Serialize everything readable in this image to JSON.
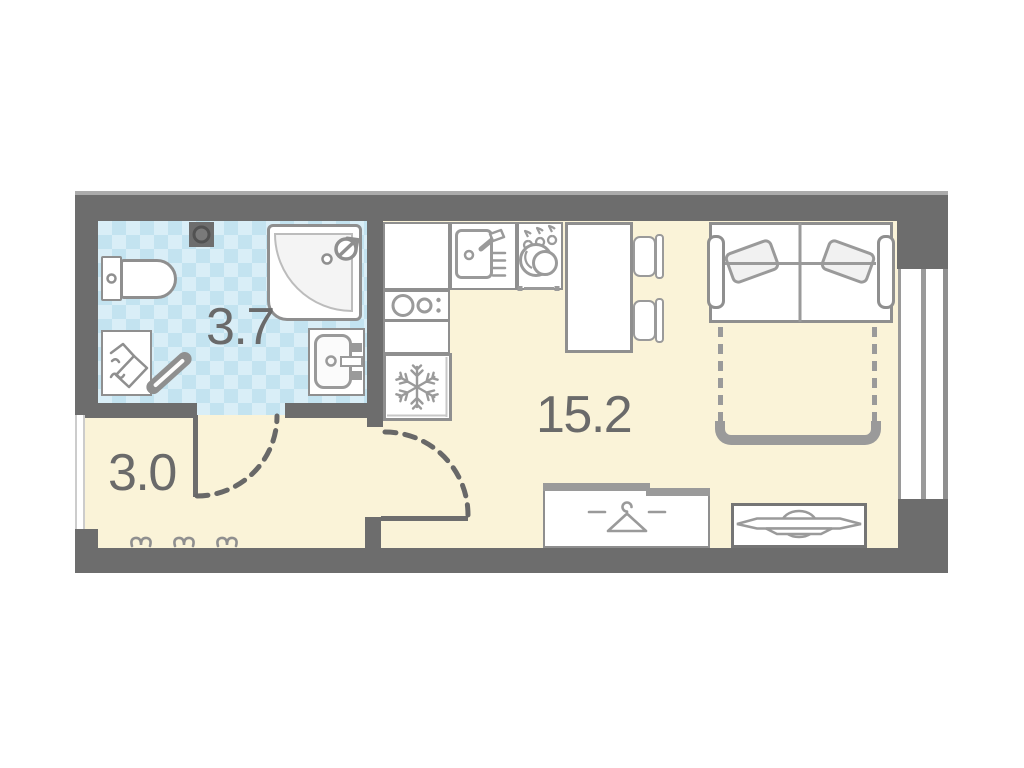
{
  "plan": {
    "type": "studio-apartment-floor-plan",
    "rooms": [
      {
        "name": "bathroom",
        "area_label": "3.7"
      },
      {
        "name": "hallway",
        "area_label": "3.0"
      },
      {
        "name": "living-kitchen",
        "area_label": "15.2"
      }
    ],
    "fixtures": [
      "toilet",
      "corner-shower",
      "bathroom-sink",
      "washing-machine",
      "vent-fan",
      "kitchen-sink",
      "dish-dryer",
      "hob-two-burners",
      "fridge-snowflake",
      "dining-table",
      "chair",
      "chair",
      "sofa-bed",
      "fold-out-bed-outline",
      "wardrobe-hanger",
      "tv-dresser",
      "coat-hooks",
      "window",
      "entrance-door-swing",
      "bathroom-door-swing"
    ],
    "colors": {
      "wall": "#6d6d6d",
      "floor": "#faf3d8",
      "tile_light": "#d9eef7",
      "tile_dark": "#c3e3f0",
      "outline": "#8f8f8f",
      "fixture": "#9a9a9a",
      "label_text": "#6a6a6a"
    }
  }
}
